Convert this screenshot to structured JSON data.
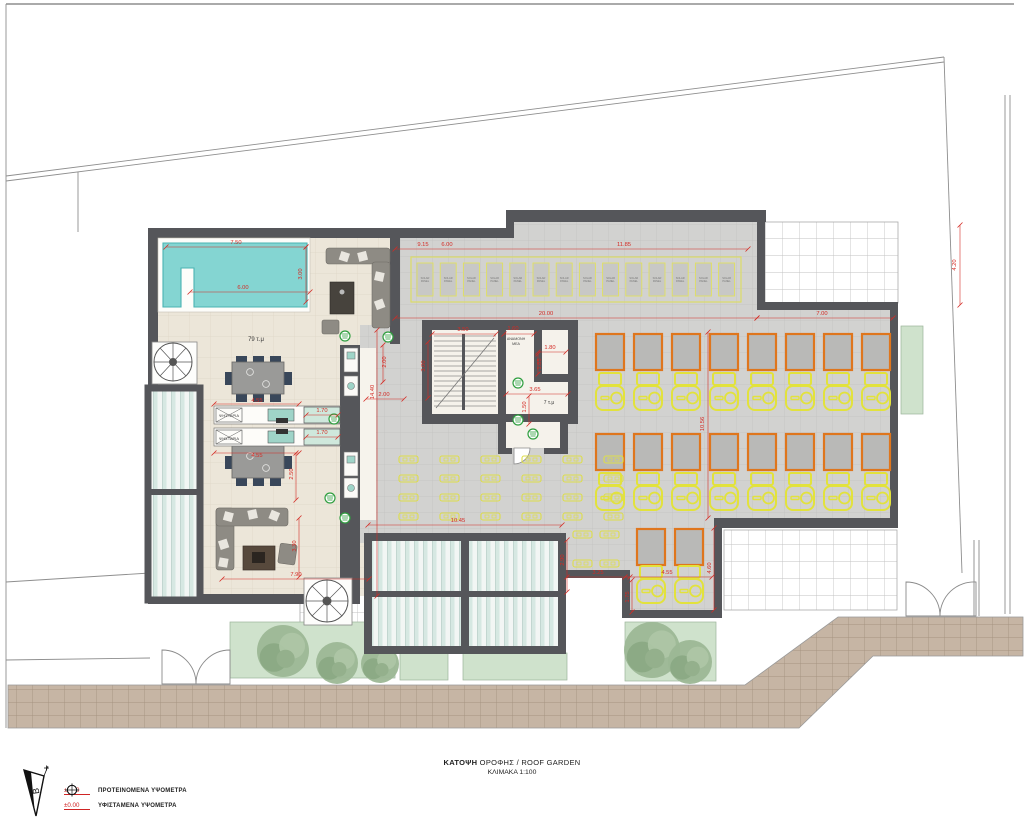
{
  "title": {
    "name_bold": "ΚΑΤΟΨΗ",
    "name_rest": " ΟΡΟΦΗΣ / ROOF GARDEN",
    "scale": "ΚΛΙΜΑΚΑ 1:100"
  },
  "legend": {
    "north": "Β",
    "items": [
      {
        "symbol": "proposed-elevation-marker",
        "value": "±0.00",
        "label": "ΠΡΟΤΕΙΝΟΜΕΝΑ ΥΨΟΜΕΤΡΑ"
      },
      {
        "symbol": "existing-elevation-marker",
        "value": "±0.00",
        "label": "ΥΦΙΣΤΑΜΕΝΑ ΥΨΟΜΕΤΡΑ"
      }
    ]
  },
  "colors": {
    "dim_red": "#d42a24",
    "wall": "#55565a",
    "pool_water": "#84d5d2",
    "lounger_yellow": "#e2e23c",
    "frame_orange": "#df761d",
    "drain_green": "#2f9e3f"
  },
  "plan": {
    "labels": [
      {
        "t": "79 τ.μ",
        "x": 256,
        "y": 341,
        "s": 6
      },
      {
        "t": "7 τ.μ",
        "x": 549,
        "y": 404,
        "s": 5
      },
      {
        "t": "ΑΝΑΜΟΝΗ",
        "x": 516,
        "y": 340,
        "s": 3.6
      },
      {
        "t": "ΜΕΑ",
        "x": 516,
        "y": 345,
        "s": 3.6
      },
      {
        "t": "ΨΗΣΤΑΡΙΑ",
        "x": 229,
        "y": 417,
        "s": 4
      },
      {
        "t": "ΨΗΣΤΑΡΙΑ",
        "x": 229,
        "y": 440,
        "s": 4
      }
    ],
    "dimensions": [
      {
        "t": "7.50",
        "x": 236,
        "y": 244,
        "l": [
          166,
          247,
          306,
          247
        ]
      },
      {
        "t": "3.00",
        "x": 302,
        "y": 274,
        "r": 1,
        "l": [
          306,
          247,
          306,
          302
        ]
      },
      {
        "t": "6.00",
        "x": 243,
        "y": 289,
        "l": [
          190,
          292,
          310,
          292
        ]
      },
      {
        "t": "9.15",
        "x": 423,
        "y": 246
      },
      {
        "t": "6.00",
        "x": 447,
        "y": 246,
        "l": [
          395,
          249,
          748,
          249
        ]
      },
      {
        "t": "11.85",
        "x": 624,
        "y": 246
      },
      {
        "t": "4.20",
        "x": 956,
        "y": 265,
        "r": 1,
        "l": [
          960,
          225,
          960,
          305
        ]
      },
      {
        "t": "20.00",
        "x": 546,
        "y": 315,
        "l": [
          395,
          318,
          757,
          318
        ]
      },
      {
        "t": "7.00",
        "x": 822,
        "y": 315,
        "l": [
          757,
          318,
          893,
          318
        ]
      },
      {
        "t": "3.50",
        "x": 463,
        "y": 331,
        "l": [
          432,
          334,
          496,
          334
        ]
      },
      {
        "t": "1.60",
        "x": 513,
        "y": 330,
        "l": [
          504,
          334,
          534,
          334
        ]
      },
      {
        "t": "3.00",
        "x": 425,
        "y": 366,
        "r": 1,
        "l": [
          428,
          342,
          428,
          398
        ]
      },
      {
        "t": "1.80",
        "x": 550,
        "y": 349,
        "l": [
          538,
          352,
          566,
          352
        ]
      },
      {
        "t": "1.85",
        "x": 541,
        "y": 364,
        "r": 1,
        "l": [
          538,
          354,
          538,
          374
        ]
      },
      {
        "t": "3.65",
        "x": 535,
        "y": 391,
        "l": [
          506,
          394,
          568,
          394
        ]
      },
      {
        "t": "1.50",
        "x": 526,
        "y": 407,
        "r": 1,
        "l": [
          529,
          396,
          529,
          424
        ]
      },
      {
        "t": "14.40",
        "x": 374,
        "y": 392,
        "r": 1,
        "l": [
          377,
          330,
          377,
          596
        ]
      },
      {
        "t": "2.00",
        "x": 386,
        "y": 362,
        "r": 1,
        "l": [
          383,
          345,
          383,
          382
        ]
      },
      {
        "t": "2.00",
        "x": 384,
        "y": 396,
        "l": [
          366,
          399,
          404,
          399
        ]
      },
      {
        "t": "4.55",
        "x": 257,
        "y": 402,
        "l": [
          214,
          404,
          299,
          404
        ]
      },
      {
        "t": "1.70",
        "x": 322,
        "y": 412,
        "l": [
          306,
          415,
          338,
          415
        ]
      },
      {
        "t": "1.70",
        "x": 322,
        "y": 434,
        "l": [
          306,
          437,
          338,
          437
        ]
      },
      {
        "t": "4.55",
        "x": 257,
        "y": 457,
        "l": [
          214,
          453,
          299,
          453
        ]
      },
      {
        "t": "2.50",
        "x": 293,
        "y": 474,
        "r": 1,
        "l": [
          296,
          453,
          296,
          500
        ]
      },
      {
        "t": "3.30",
        "x": 296,
        "y": 546,
        "r": 1,
        "l": [
          299,
          518,
          299,
          577
        ]
      },
      {
        "t": "7.90",
        "x": 296,
        "y": 576,
        "l": [
          222,
          579,
          369,
          579
        ]
      },
      {
        "t": "10.45",
        "x": 458,
        "y": 522,
        "l": [
          368,
          525,
          562,
          525
        ]
      },
      {
        "t": "10.56",
        "x": 704,
        "y": 424,
        "r": 1,
        "l": [
          708,
          332,
          708,
          518
        ]
      },
      {
        "t": "2.90",
        "x": 564,
        "y": 560,
        "r": 1,
        "l": [
          567,
          540,
          567,
          592
        ]
      },
      {
        "t": "3.25",
        "x": 598,
        "y": 574,
        "l": [
          567,
          577,
          630,
          577
        ]
      },
      {
        "t": "4.55",
        "x": 667,
        "y": 574,
        "l": [
          625,
          577,
          712,
          577
        ]
      },
      {
        "t": "1.75",
        "x": 629,
        "y": 597,
        "r": 1,
        "l": [
          632,
          580,
          632,
          612
        ]
      },
      {
        "t": "4.60",
        "x": 711,
        "y": 568,
        "r": 1,
        "l": [
          714,
          528,
          714,
          610
        ]
      }
    ],
    "solar": {
      "count": 14,
      "x0": 417,
      "y": 263,
      "w": 16,
      "h": 33,
      "pitch": 23.2,
      "boundary": [
        411,
        257,
        330,
        45
      ],
      "label1": "SOLAR",
      "label2": "PANEL"
    },
    "loungers": {
      "cols": 8,
      "x0": 596,
      "pitch": 38,
      "sq_w": 28,
      "sq_h": 36,
      "rows": [
        {
          "sy": 334,
          "ly": 373
        },
        {
          "sy": 434,
          "ly": 473
        }
      ],
      "bottom": [
        {
          "x": 637,
          "sy": 529,
          "ly": 566
        },
        {
          "x": 675,
          "sy": 529,
          "ly": 566
        }
      ]
    },
    "minitables": [
      {
        "x0": 399,
        "y0": 456,
        "cols": 6,
        "rows": 4,
        "px": 41,
        "py": 19
      },
      {
        "x0": 573,
        "y0": 531,
        "cols": 2,
        "rows": 2,
        "px": 27,
        "py": 29
      }
    ],
    "drains": [
      [
        345,
        336
      ],
      [
        388,
        337
      ],
      [
        334,
        419
      ],
      [
        330,
        498
      ],
      [
        345,
        518
      ],
      [
        518,
        383
      ],
      [
        518,
        420
      ],
      [
        533,
        434
      ]
    ],
    "trees": [
      {
        "x": 283,
        "y": 651,
        "r": 26
      },
      {
        "x": 337,
        "y": 663,
        "r": 21
      },
      {
        "x": 380,
        "y": 664,
        "r": 19
      },
      {
        "x": 652,
        "y": 650,
        "r": 28
      },
      {
        "x": 690,
        "y": 662,
        "r": 22
      }
    ]
  }
}
